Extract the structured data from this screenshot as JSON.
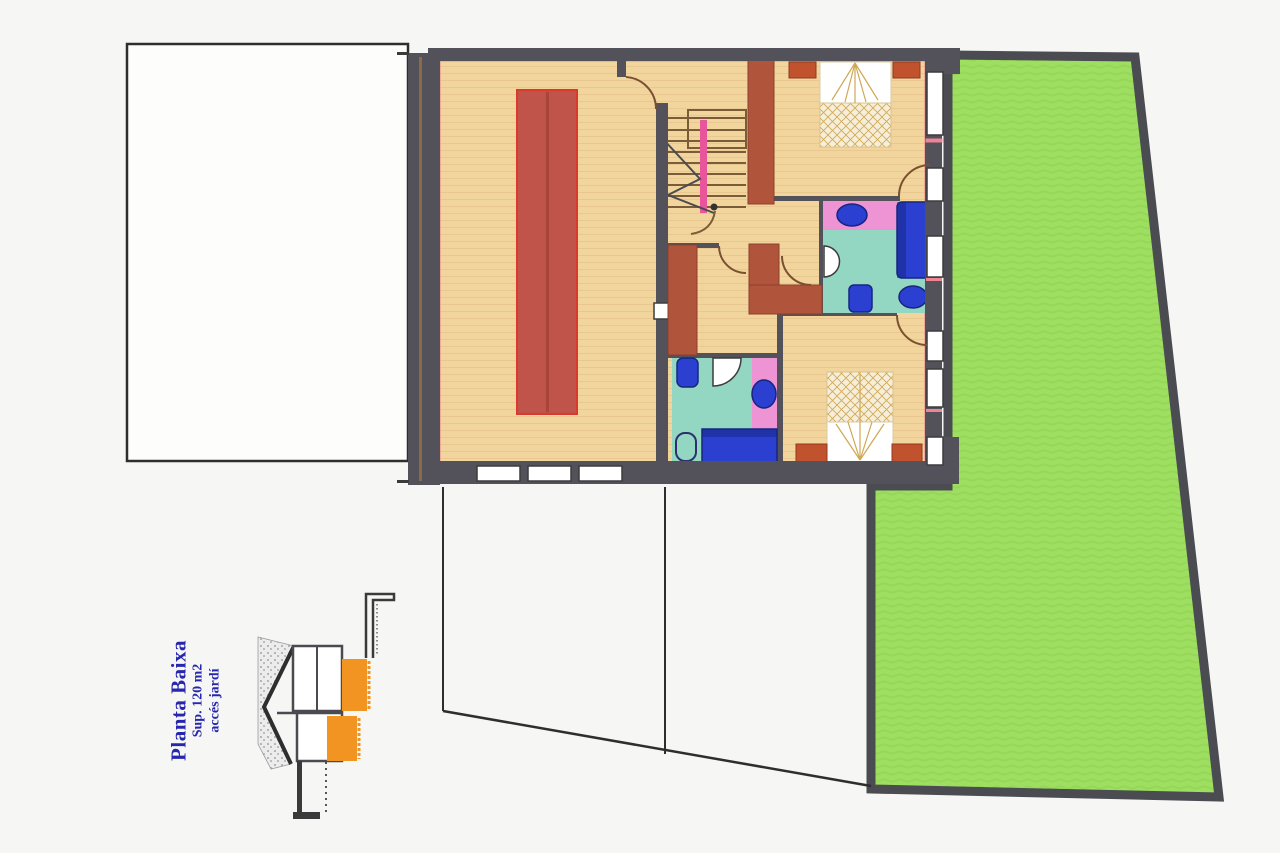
{
  "legend": {
    "title": "Planta Baixa",
    "area": "Sup. 120 m2",
    "access": "accés jardí"
  },
  "colors": {
    "paper": "#f6f6f4",
    "plot_fill": "#fdfdfc",
    "wall_dark": "#53525a",
    "wall_terracotta": "#b1543c",
    "floor_tan": "#f2d49d",
    "floor_tan_line": "#dcb97f",
    "rug_red": "#c1544a",
    "rug_border": "#d93a2c",
    "pink_line": "#ee8494",
    "bath_cyan": "#93d7c3",
    "bath_pink": "#ee93d4",
    "fixture_blue": "#2b3fd0",
    "fixture_blue_dark": "#16267f",
    "garden_green": "#9ede60",
    "garden_green_alt": "#95d857",
    "garden_border": "#4b4b52",
    "bed_cream": "#f6eed8",
    "bed_gold": "#cfa855",
    "nightstand": "#c0522e",
    "stair_brown": "#7a5c38",
    "stair_pink": "#e8559a",
    "section_orange": "#f29422",
    "door_arc": "#7a5030",
    "ink": "#2e2e2e",
    "label_blue": "#2626ae"
  }
}
